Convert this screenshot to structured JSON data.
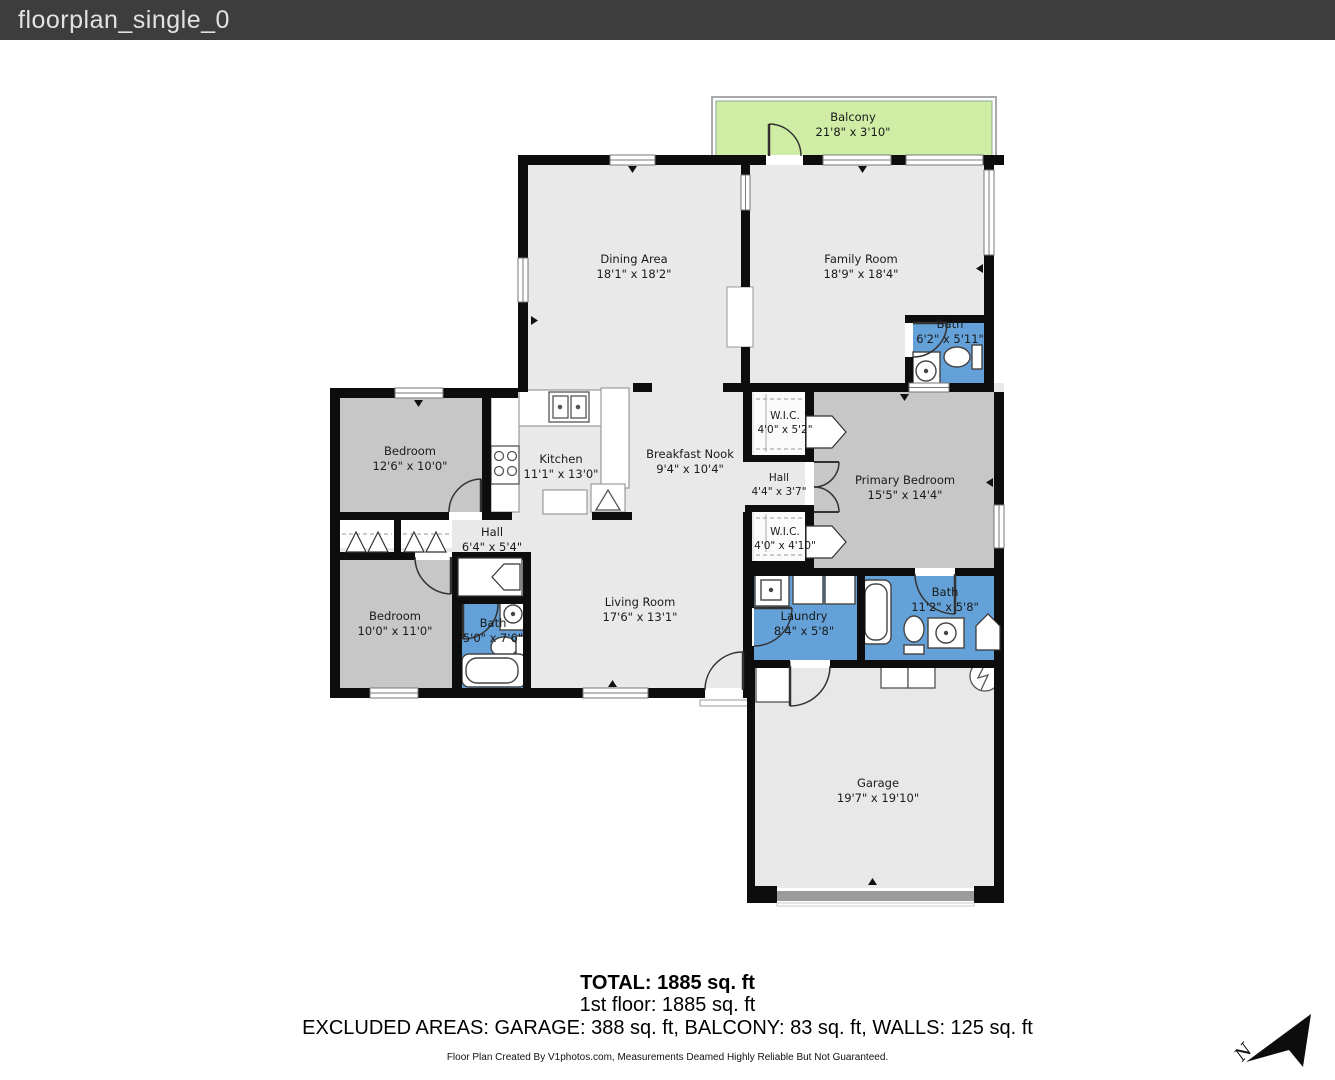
{
  "header": {
    "title": "floorplan_single_0"
  },
  "rooms": {
    "balcony": {
      "name": "Balcony",
      "dims": "21'8\" x 3'10\""
    },
    "dining": {
      "name": "Dining Area",
      "dims": "18'1\" x 18'2\""
    },
    "family": {
      "name": "Family Room",
      "dims": "18'9\" x 18'4\""
    },
    "bath_upper": {
      "name": "Bath",
      "dims": "6'2\" x 5'11\""
    },
    "bedroom_upper": {
      "name": "Bedroom",
      "dims": "12'6\" x 10'0\""
    },
    "kitchen": {
      "name": "Kitchen",
      "dims": "11'1\" x 13'0\""
    },
    "breakfast_nook": {
      "name": "Breakfast Nook",
      "dims": "9'4\" x 10'4\""
    },
    "wic_top": {
      "name": "W.I.C.",
      "dims": "4'0\" x 5'2\""
    },
    "hall_center": {
      "name": "Hall",
      "dims": "4'4\" x 3'7\""
    },
    "wic_bottom": {
      "name": "W.I.C.",
      "dims": "4'0\" x 4'10\""
    },
    "primary_bedroom": {
      "name": "Primary Bedroom",
      "dims": "15'5\" x 14'4\""
    },
    "hall_west": {
      "name": "Hall",
      "dims": "6'4\" x 5'4\""
    },
    "bedroom_lower": {
      "name": "Bedroom",
      "dims": "10'0\" x 11'0\""
    },
    "bath_small": {
      "name": "Bath",
      "dims": "5'0\" x 7'6\""
    },
    "living": {
      "name": "Living Room",
      "dims": "17'6\" x 13'1\""
    },
    "laundry": {
      "name": "Laundry",
      "dims": "8'4\" x 5'8\""
    },
    "bath_right": {
      "name": "Bath",
      "dims": "11'2\" x 5'8\""
    },
    "garage": {
      "name": "Garage",
      "dims": "19'7\" x 19'10\""
    }
  },
  "summary": {
    "total": "TOTAL: 1885 sq. ft",
    "floor": "1st floor: 1885 sq. ft",
    "excluded": "EXCLUDED AREAS: GARAGE: 388 sq. ft, BALCONY: 83 sq. ft, WALLS: 125 sq. ft",
    "disclaimer": "Floor Plan Created By V1photos.com, Measurements Deamed Highly Reliable But Not Guaranteed."
  },
  "compass": {
    "label": "N"
  },
  "colors": {
    "header_bg": "#3d3d3d",
    "wall": "#0d0d0d",
    "room_light": "#e9e9e9",
    "room_dark": "#c7c7c7",
    "wet_blue": "#64a1d8",
    "balcony_green": "#cfeda4",
    "garage_door_gray": "#9b9b9b"
  }
}
